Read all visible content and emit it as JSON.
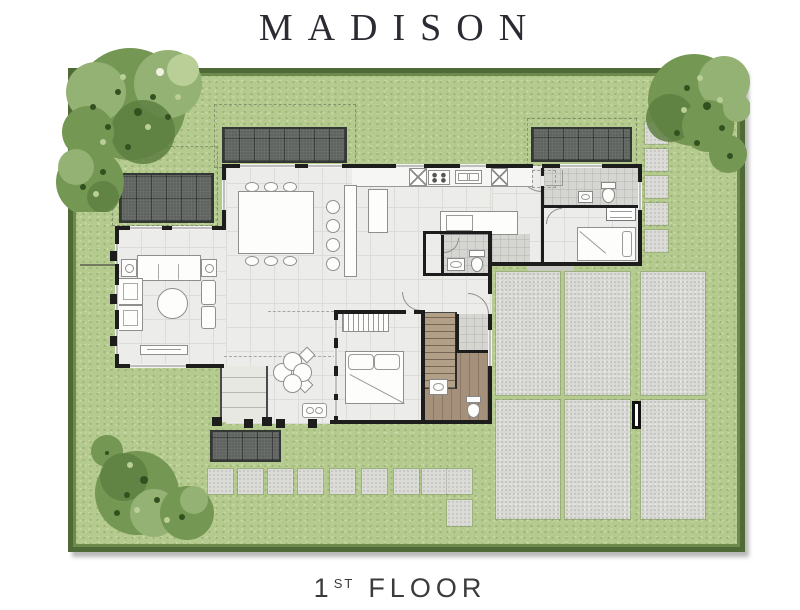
{
  "title": "MADISON",
  "floor_label": {
    "number": "1",
    "ordinal": "ST",
    "word": "FLOOR"
  },
  "colors": {
    "c-bg": "#ffffff",
    "c-title": "#2b2b33",
    "c-lawn": "#b4ca8e",
    "c-lawn-speck-dark": "#9cb574",
    "c-lawn-speck-light": "#c6d7a3",
    "c-lawn-border": "#4f6a36",
    "c-lawn-border-in": "#6d8a4c",
    "c-pad": "#d8d8d4",
    "c-stone": "#dbdbd7",
    "c-awning": "#5c615d",
    "c-awning-dark": "#343835",
    "c-wall": "#1d1d1d",
    "c-floor": "#ecedea",
    "c-floor-line": "#dddcd6",
    "c-tile": "#d5d5d1",
    "c-wood": "#b29f88",
    "c-bath-wood": "#a5917b",
    "c-furn-line": "#8f8f8f",
    "c-tree-dark": "#5d7f42",
    "c-tree-mid": "#749753",
    "c-tree-light": "#93b273",
    "c-tree-pale": "#b9cf97",
    "c-tree-speck": "#33501f"
  }
}
